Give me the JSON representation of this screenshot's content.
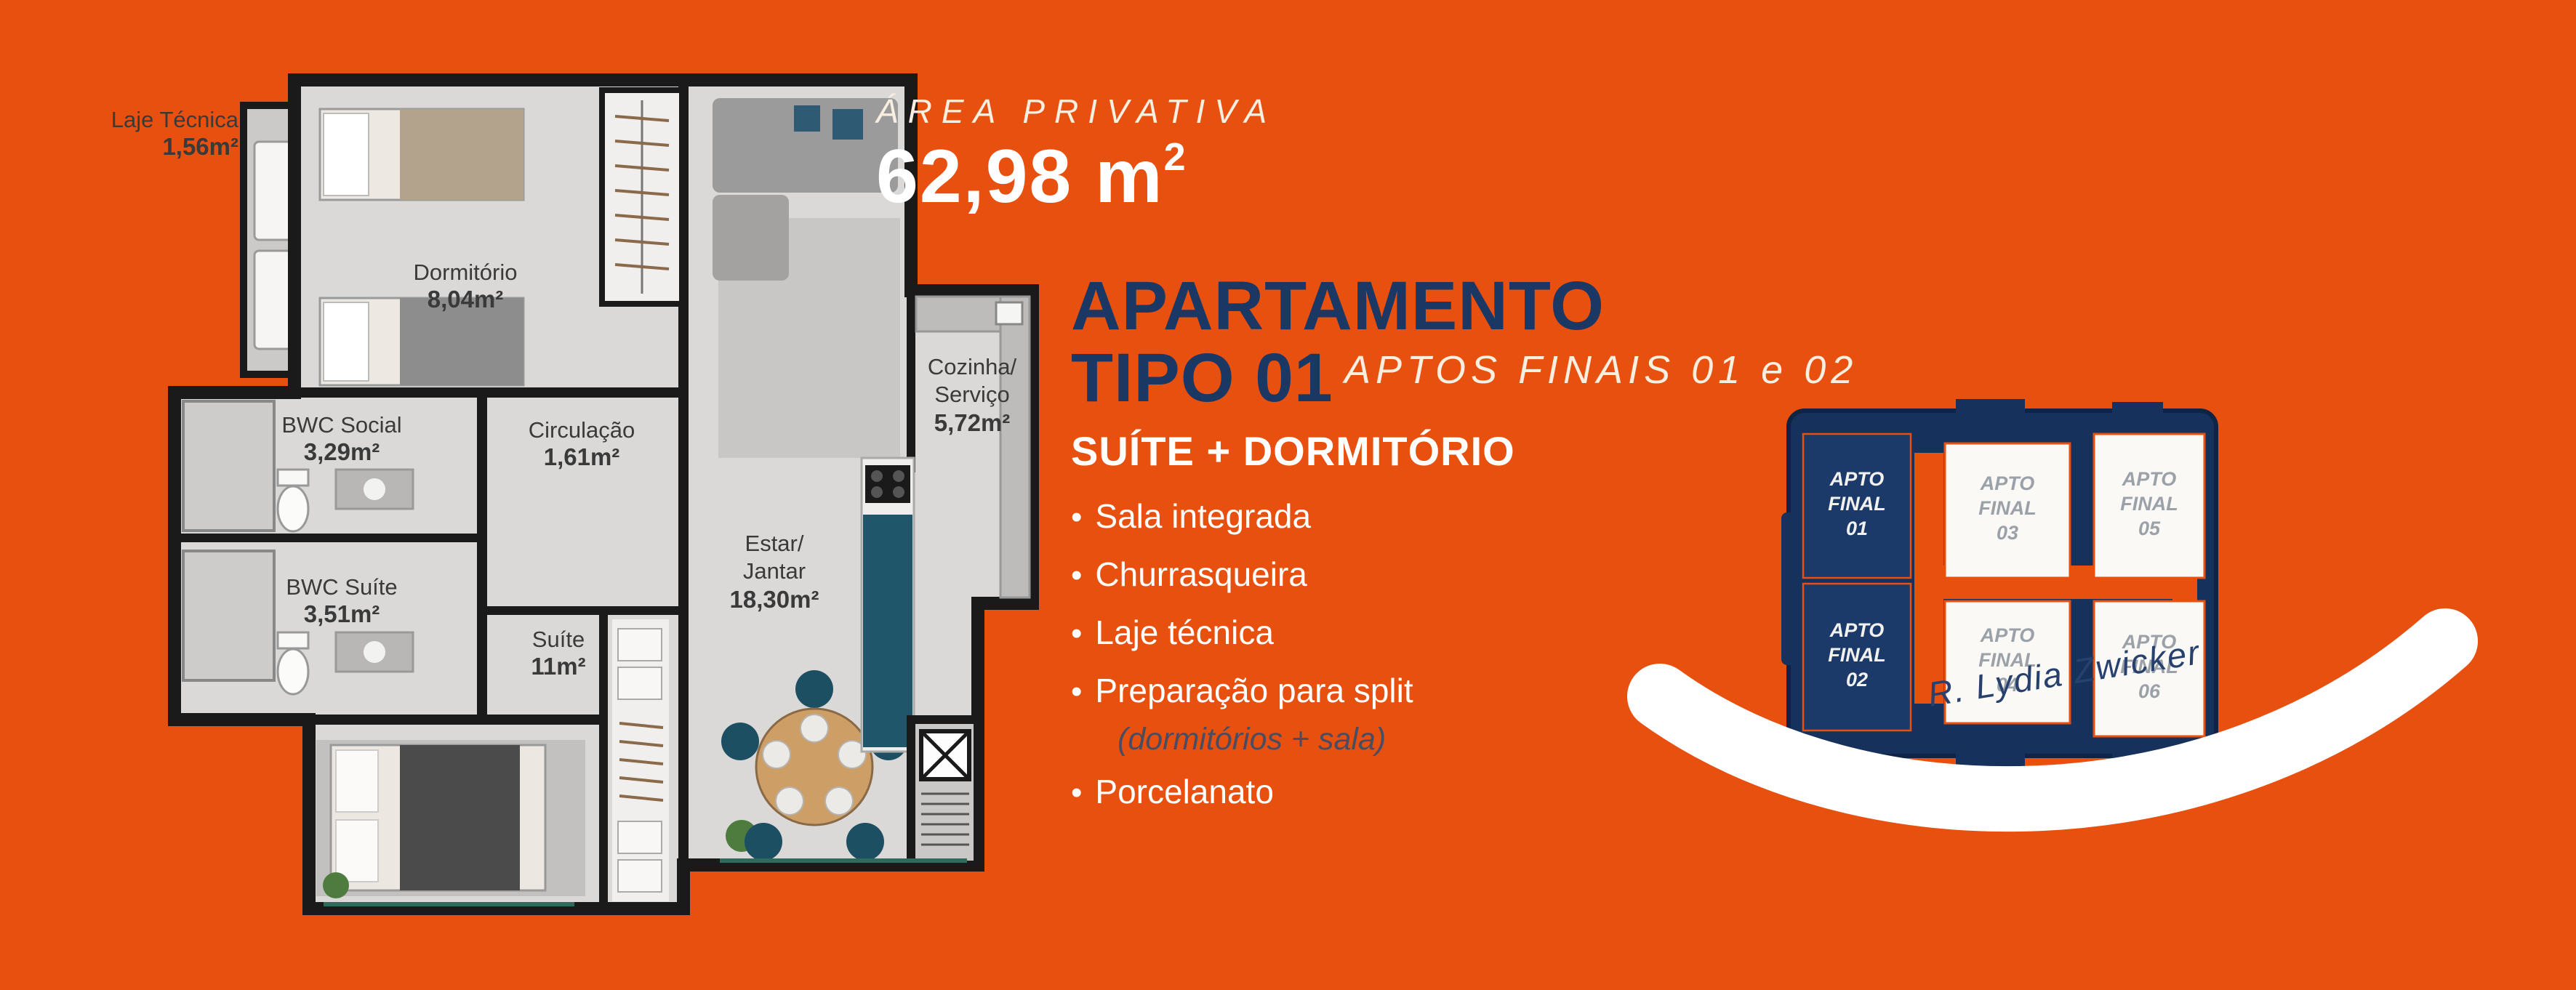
{
  "colors": {
    "background": "#E8500F",
    "title_navy": "#1B3764",
    "keyplan_navy": "#16325C",
    "keyplan_unit_navy": "#1B3A69",
    "cream_text": "#F8EFE1",
    "white": "#FFFFFF",
    "note_muted": "#4A4D61",
    "plan_wall": "#1A1A1A",
    "plan_floor": "#DAD9D7",
    "plan_label": "#3A3A3A",
    "keyplan_muted_text": "#9BA1A9",
    "teal_accent": "#20566A"
  },
  "area_block": {
    "label": "ÁREA PRIVATIVA",
    "value": "62,98 m",
    "sup": "2"
  },
  "title_block": {
    "line1": "APARTAMENTO",
    "line2": "TIPO 01",
    "subtitle": "APTOS FINAIS 01 e 02"
  },
  "features": {
    "heading": "SUÍTE + DORMITÓRIO",
    "bullet_char": "•",
    "items": [
      {
        "label": "Sala integrada"
      },
      {
        "label": "Churrasqueira"
      },
      {
        "label": "Laje técnica"
      },
      {
        "label": "Preparação para split",
        "note": "(dormitórios + sala)"
      },
      {
        "label": "Porcelanato"
      }
    ]
  },
  "floor_plan": {
    "exterior_label": {
      "name": "Laje Técnica",
      "area": "1,56m²"
    },
    "rooms": {
      "dormitorio": {
        "name": "Dormitório",
        "area": "8,04m²"
      },
      "bwc_social": {
        "name": "BWC Social",
        "area": "3,29m²"
      },
      "circulacao": {
        "name": "Circulação",
        "area": "1,61m²"
      },
      "bwc_suite": {
        "name": "BWC Suíte",
        "area": "3,51m²"
      },
      "suite": {
        "name": "Suíte",
        "area": "11m²"
      },
      "estar_jantar": {
        "line1": "Estar/",
        "line2": "Jantar",
        "area": "18,30m²"
      },
      "cozinha": {
        "line1": "Cozinha/",
        "line2": "Serviço",
        "area": "5,72m²"
      }
    }
  },
  "key_plan": {
    "units": [
      {
        "line1": "APTO",
        "line2": "FINAL",
        "line3": "01",
        "highlighted": true
      },
      {
        "line1": "APTO",
        "line2": "FINAL",
        "line3": "02",
        "highlighted": true
      },
      {
        "line1": "APTO",
        "line2": "FINAL",
        "line3": "03",
        "highlighted": false
      },
      {
        "line1": "APTO",
        "line2": "FINAL",
        "line3": "04",
        "highlighted": false
      },
      {
        "line1": "APTO",
        "line2": "FINAL",
        "line3": "05",
        "highlighted": false
      },
      {
        "line1": "APTO",
        "line2": "FINAL",
        "line3": "06",
        "highlighted": false
      }
    ],
    "street": "R. Lydia Zwicker"
  }
}
